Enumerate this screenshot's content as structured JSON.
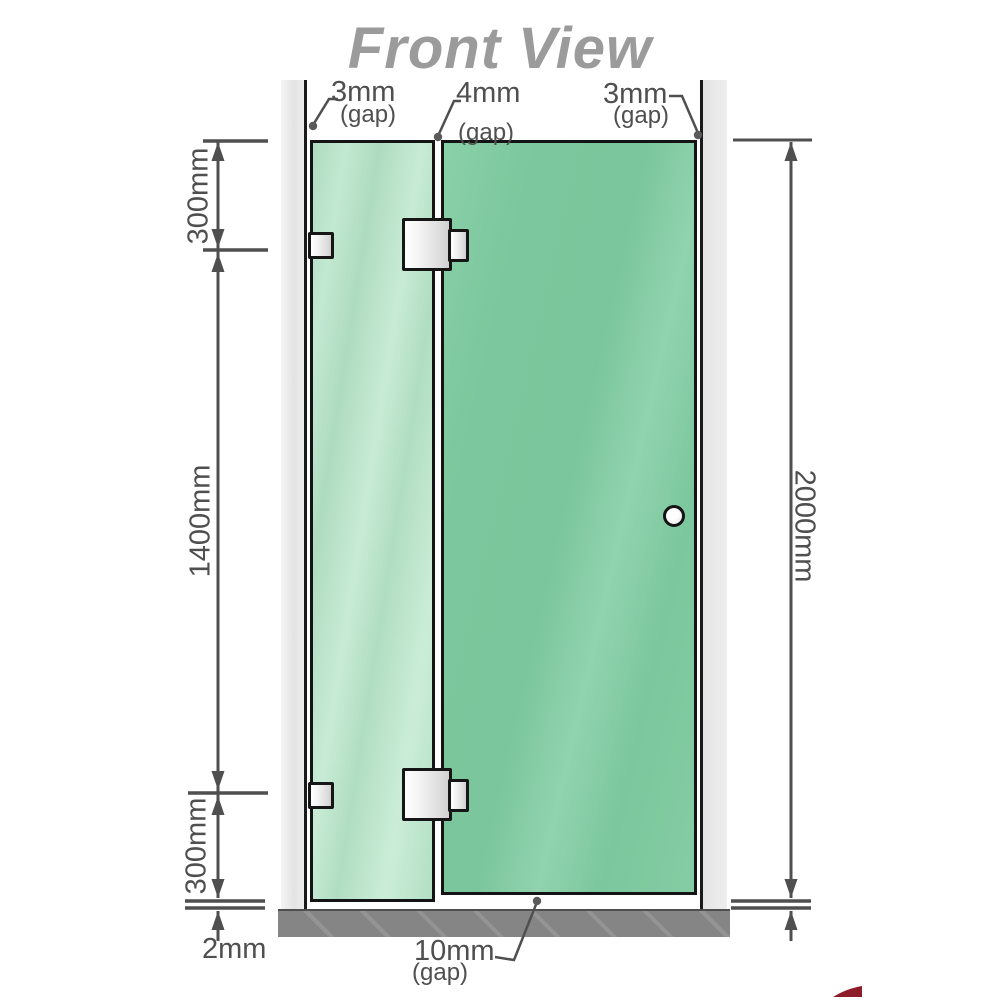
{
  "title": "Front View",
  "annotations": {
    "top_gaps": [
      {
        "value": "3mm",
        "qualifier": "(gap)"
      },
      {
        "value": "4mm",
        "qualifier": "(gap)"
      },
      {
        "value": "3mm",
        "qualifier": "(gap)"
      }
    ],
    "left_heights": {
      "top": "300mm",
      "middle": "1400mm",
      "bottom": "300mm"
    },
    "overall_height": "2000mm",
    "floor_gap": "2mm",
    "door_bottom_gap": {
      "value": "10mm",
      "qualifier": "(gap)"
    }
  },
  "parts": {
    "left_wall": "wall-strip",
    "right_wall": "wall-strip",
    "fixed_panel": "glass-panel",
    "door_panel": "glass-door-panel",
    "hardware": [
      "wall-bracket-upper",
      "wall-bracket-lower",
      "glass-hinge-upper",
      "glass-hinge-lower",
      "round-knob-handle"
    ],
    "base": "floor-base-bar"
  },
  "colors": {
    "title": "#9b9b9b",
    "dimension_text": "#4f4f4f",
    "glass_fixed": "#b5e1c6",
    "glass_door": "#7cc79d",
    "wall": "#e9e9e9",
    "base": "#858585",
    "logo_fragment_red": "#8b1c28"
  }
}
